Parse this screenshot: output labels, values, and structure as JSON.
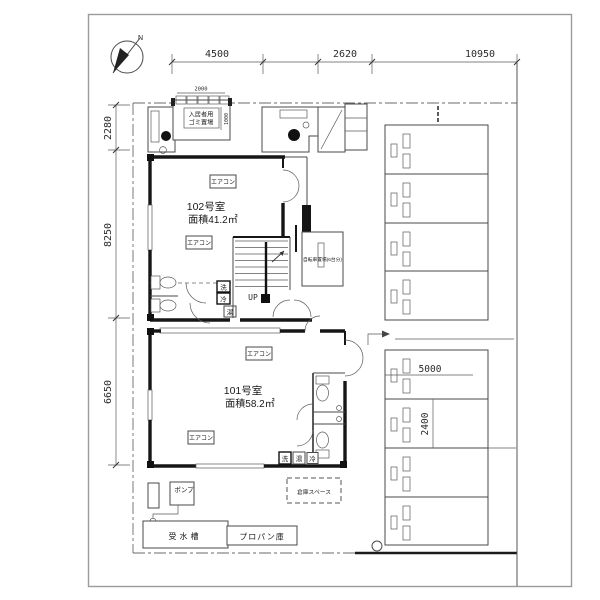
{
  "colors": {
    "paper": "#ffffff",
    "wall": "#161616",
    "line": "#4a4a4a",
    "page_border": "#9b9b9b"
  },
  "compass": {
    "north_label": "N"
  },
  "dimensions": {
    "top": [
      "4500",
      "2620",
      "10950"
    ],
    "left": [
      "2280",
      "8250",
      "6650"
    ],
    "trash_width": "2000",
    "trash_depth": "1000",
    "parking_length": "5000",
    "parking_width": "2400"
  },
  "rooms": {
    "room102": {
      "name": "102号室",
      "area": "面積41.2㎡"
    },
    "room101": {
      "name": "101号室",
      "area": "面積58.2㎡"
    }
  },
  "labels": {
    "aircon": "エアコン",
    "trash_line1": "入居者用",
    "trash_line2": "ゴミ置場",
    "bicycle": "自転車置場(6台分)",
    "up": "UP",
    "pump": "ポンプ",
    "water_tank": "受水槽",
    "propane": "プロパン庫",
    "storage_space": "倉庫スペース",
    "washer": "洗",
    "fridge": "冷",
    "heater": "湯"
  }
}
